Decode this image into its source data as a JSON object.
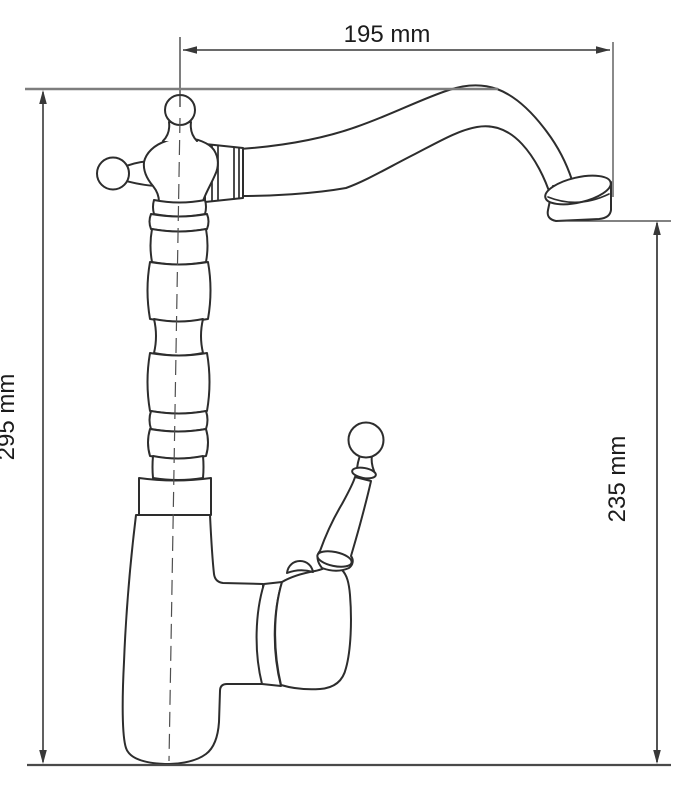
{
  "theme": {
    "background": "#ffffff",
    "outline": "#2d2d2d",
    "dimension": "#383838",
    "reference": "#7d7d7d",
    "baseline": "#4a4a4a",
    "label": "#1c1c1c"
  },
  "drawing": {
    "subject": "Single-lever kitchen faucet with swan-neck spout, side elevation",
    "view": "side",
    "dimensions": [
      {
        "id": "spout-reach",
        "label": "195 mm",
        "orientation": "horizontal"
      },
      {
        "id": "total-height",
        "label": "295 mm",
        "orientation": "vertical"
      },
      {
        "id": "outlet-height",
        "label": "235 mm",
        "orientation": "vertical"
      }
    ]
  }
}
